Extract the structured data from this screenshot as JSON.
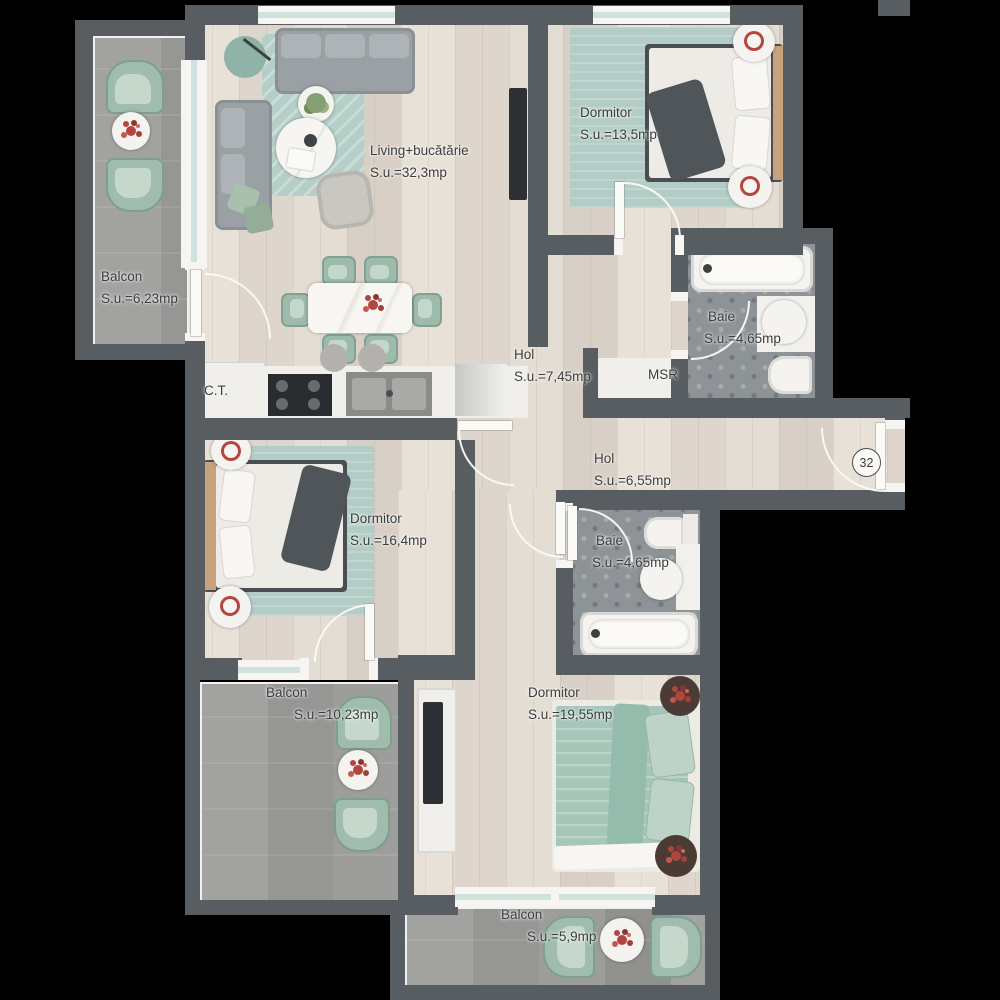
{
  "apartment_number": "32",
  "rooms": {
    "living": {
      "name": "Living+bucătărie",
      "area": "S.u.=32,3mp"
    },
    "dormitor1": {
      "name": "Dormitor",
      "area": "S.u.=13,5mp"
    },
    "balcon1": {
      "name": "Balcon",
      "area": "S.u.=6,23mp"
    },
    "hol1": {
      "name": "Hol",
      "area": "S.u.=7,45mp"
    },
    "msr": {
      "name": "MSR"
    },
    "baie1": {
      "name": "Baie",
      "area": "S.u.=4,65mp"
    },
    "ct": {
      "name": "C.T."
    },
    "hol2": {
      "name": "Hol",
      "area": "S.u.=6,55mp"
    },
    "dormitor2": {
      "name": "Dormitor",
      "area": "S.u.=16,4mp"
    },
    "baie2": {
      "name": "Baie",
      "area": "S.u.=4,65mp"
    },
    "dormitor3": {
      "name": "Dormitor",
      "area": "S.u.=19,55mp"
    },
    "balcon2": {
      "name": "Balcon",
      "area": "S.u.=10,23mp"
    },
    "balcon3": {
      "name": "Balcon",
      "area": "S.u.=5,9mp"
    }
  },
  "colors": {
    "wall": "#585d61",
    "wood_floor": "#e3dcd3",
    "balcony_floor": "#9c9c9a",
    "tile_floor": "#8d9397",
    "rug_teal": "#b5cfc8",
    "furniture_sage": "#9dbbac",
    "flower_red": "#b2453e",
    "fixture_white": "#f2f1ed",
    "background": "#000000"
  }
}
